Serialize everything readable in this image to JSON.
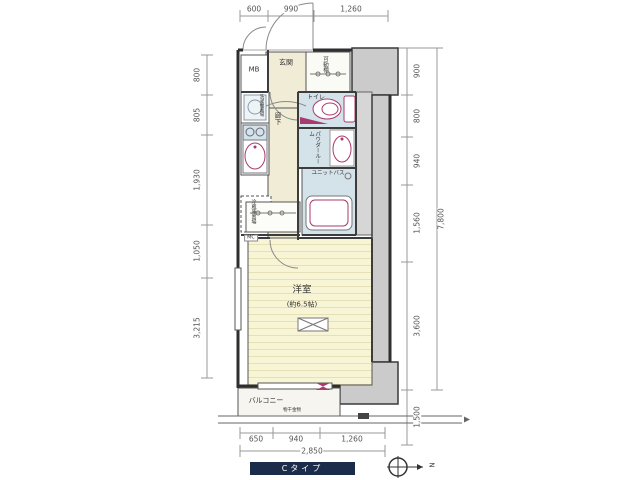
{
  "plan": {
    "type_label": "Cタイプ",
    "compass_letter": "N",
    "rooms": {
      "mb": "MB",
      "entrance": "玄関",
      "movable_shelf": "可動棚",
      "toilet": "トイレ",
      "powder_room": "パウダールーム",
      "unit_bath": "ユニットバス",
      "hallway": "廊下",
      "washer_space": "洗濯機置場",
      "fridge_space": "冷蔵庫置場",
      "closet": "MC",
      "main_room": "洋室",
      "main_room_size": "(約6.5帖)",
      "balcony": "バルコニー",
      "laundry_hardware": "物干金物"
    },
    "dimensions": {
      "top": [
        "600",
        "990",
        "1,260"
      ],
      "left": [
        "800",
        "805",
        "1,930",
        "1,050",
        "3,215"
      ],
      "right": [
        "900",
        "800",
        "940",
        "1,560",
        "3,600",
        "1,500"
      ],
      "right_total": "7,800",
      "bottom": [
        "650",
        "940",
        "1,260"
      ],
      "bottom_total": "2,850"
    },
    "colors": {
      "wall_fill": "#cbcbcb",
      "wet_area_floor": "#d4e3ea",
      "wood_floor": "#f8f4d6",
      "entry_floor": "#f1ecd6",
      "fixture_accent": "#a93a6e",
      "type_bar": "#1b2b4a"
    }
  }
}
